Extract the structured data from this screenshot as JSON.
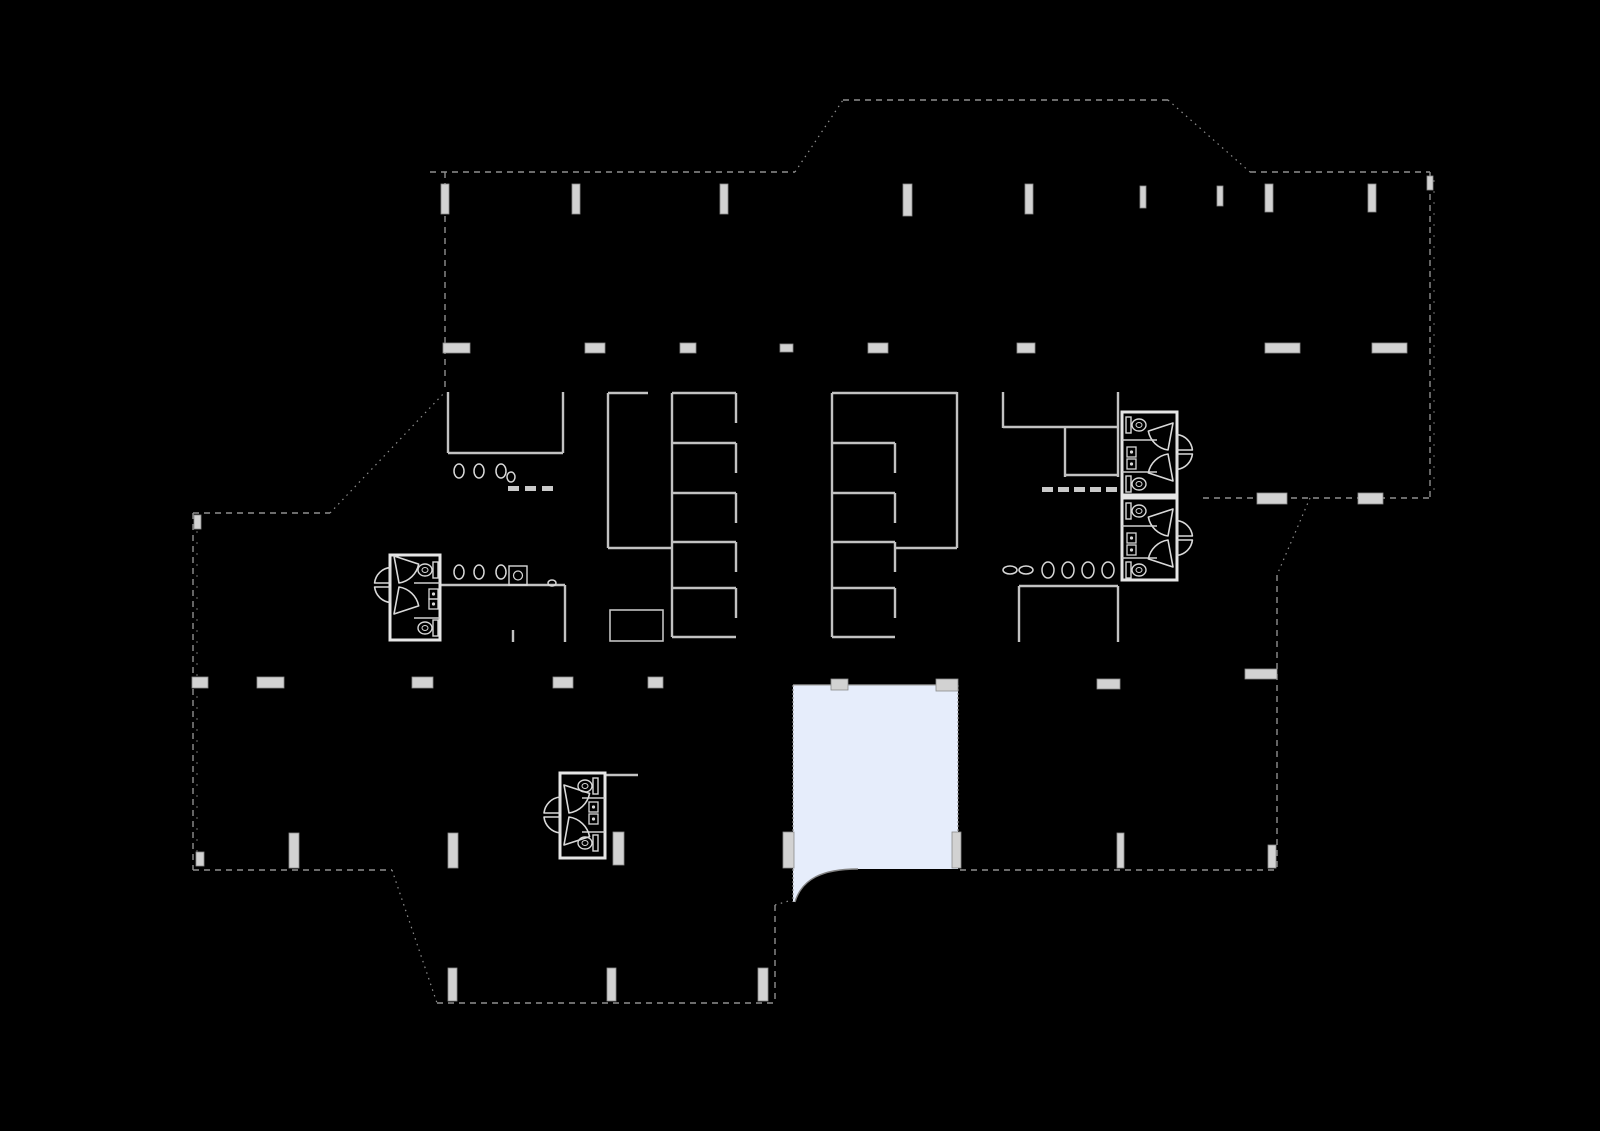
{
  "canvas": {
    "width": 1600,
    "height": 1131,
    "background": "#000000"
  },
  "palette": {
    "exterior_wall": "#8f8f8f",
    "exterior_tick": "#6f6f6f",
    "interior_wall": "#c2c2c2",
    "thin_wall": "#a8a8a8",
    "bright_wall": "#e6e6e6",
    "partition": "#cfcfcf",
    "column_fill": "#d2d2d2",
    "column_stroke": "#8a8a8a",
    "fixture": "#d8d8d8",
    "door": "#d9d9d9",
    "highlight_fill": "#e6edfb",
    "highlight_edge": "#909090",
    "highlight_arc": "#828282"
  },
  "floorplan": {
    "exterior_walls_dashed": [
      [
        430,
        172,
        795,
        172
      ],
      [
        843,
        100,
        1168,
        100
      ],
      [
        1250,
        172,
        1430,
        172
      ],
      [
        1430,
        172,
        1430,
        498
      ],
      [
        1203,
        498,
        1430,
        498
      ],
      [
        1277,
        575,
        1277,
        870
      ],
      [
        960,
        870,
        1277,
        870
      ],
      [
        437,
        1003,
        775,
        1003
      ],
      [
        193,
        870,
        392,
        870
      ],
      [
        193,
        513,
        193,
        870
      ],
      [
        193,
        513,
        330,
        513
      ],
      [
        445,
        172,
        445,
        392
      ],
      [
        775,
        905,
        775,
        1003
      ]
    ],
    "exterior_walls_dotted": [
      [
        795,
        172,
        843,
        100
      ],
      [
        1168,
        100,
        1250,
        172
      ],
      [
        1310,
        498,
        1277,
        575
      ],
      [
        330,
        513,
        445,
        392
      ],
      [
        392,
        870,
        437,
        1003
      ],
      [
        775,
        905,
        792,
        900
      ]
    ],
    "window_tick_lines": [
      [
        1434,
        180,
        1434,
        494
      ],
      [
        197,
        520,
        197,
        864
      ]
    ],
    "interior_walls": [
      [
        448,
        392,
        448,
        453
      ],
      [
        563,
        392,
        563,
        453
      ],
      [
        448,
        453,
        563,
        453
      ],
      [
        608,
        393,
        608,
        548
      ],
      [
        608,
        393,
        648,
        393
      ],
      [
        608,
        548,
        672,
        548
      ],
      [
        672,
        393,
        672,
        637
      ],
      [
        672,
        393,
        736,
        393
      ],
      [
        672,
        443,
        736,
        443
      ],
      [
        672,
        493,
        736,
        493
      ],
      [
        672,
        542,
        736,
        542
      ],
      [
        672,
        588,
        736,
        588
      ],
      [
        672,
        637,
        736,
        637
      ],
      [
        736,
        393,
        736,
        423
      ],
      [
        736,
        443,
        736,
        473
      ],
      [
        736,
        493,
        736,
        523
      ],
      [
        736,
        542,
        736,
        572
      ],
      [
        736,
        588,
        736,
        618
      ],
      [
        832,
        393,
        832,
        637
      ],
      [
        832,
        393,
        957,
        393
      ],
      [
        832,
        443,
        895,
        443
      ],
      [
        832,
        493,
        895,
        493
      ],
      [
        832,
        542,
        895,
        542
      ],
      [
        832,
        588,
        895,
        588
      ],
      [
        832,
        637,
        895,
        637
      ],
      [
        895,
        443,
        895,
        473
      ],
      [
        895,
        493,
        895,
        523
      ],
      [
        895,
        542,
        895,
        572
      ],
      [
        895,
        588,
        895,
        618
      ],
      [
        957,
        392,
        957,
        548
      ],
      [
        895,
        548,
        957,
        548
      ],
      [
        1003,
        392,
        1003,
        428
      ],
      [
        1003,
        427,
        1118,
        427
      ],
      [
        1065,
        427,
        1065,
        477
      ],
      [
        1065,
        475,
        1118,
        475
      ],
      [
        1118,
        392,
        1118,
        477
      ],
      [
        1019,
        586,
        1118,
        586
      ],
      [
        1019,
        586,
        1019,
        642
      ],
      [
        1118,
        586,
        1118,
        642
      ],
      [
        440,
        585,
        565,
        585
      ],
      [
        565,
        585,
        565,
        642
      ],
      [
        513,
        630,
        513,
        642
      ],
      [
        605,
        775,
        638,
        775
      ]
    ],
    "thin_walls": [
      [
        793,
        685,
        958,
        685
      ]
    ],
    "outline_rects": [
      {
        "x": 610,
        "y": 610,
        "w": 53,
        "h": 31
      }
    ],
    "bathroom_blocks": [
      {
        "x": 390,
        "y": 555,
        "w": 50,
        "h": 85
      },
      {
        "x": 560,
        "y": 773,
        "w": 45,
        "h": 85
      },
      {
        "x": 1122,
        "y": 412,
        "w": 55,
        "h": 83
      },
      {
        "x": 1122,
        "y": 498,
        "w": 55,
        "h": 82
      }
    ],
    "stall_partitions": [
      [
        414,
        583,
        440,
        583
      ],
      [
        414,
        618,
        440,
        618
      ],
      [
        582,
        798,
        605,
        798
      ],
      [
        582,
        832,
        605,
        832
      ],
      [
        1122,
        440,
        1157,
        440
      ],
      [
        1122,
        472,
        1157,
        472
      ],
      [
        1122,
        526,
        1157,
        526
      ],
      [
        1122,
        558,
        1157,
        558
      ]
    ],
    "columns": [
      {
        "x": 441,
        "y": 184,
        "w": 8,
        "h": 30
      },
      {
        "x": 572,
        "y": 184,
        "w": 8,
        "h": 30
      },
      {
        "x": 720,
        "y": 184,
        "w": 8,
        "h": 30
      },
      {
        "x": 903,
        "y": 184,
        "w": 9,
        "h": 32
      },
      {
        "x": 1025,
        "y": 184,
        "w": 8,
        "h": 30
      },
      {
        "x": 1140,
        "y": 186,
        "w": 6,
        "h": 22
      },
      {
        "x": 1217,
        "y": 186,
        "w": 6,
        "h": 20
      },
      {
        "x": 1265,
        "y": 184,
        "w": 8,
        "h": 28
      },
      {
        "x": 1368,
        "y": 184,
        "w": 8,
        "h": 28
      },
      {
        "x": 194,
        "y": 515,
        "w": 7,
        "h": 14
      },
      {
        "x": 1427,
        "y": 176,
        "w": 6,
        "h": 14
      },
      {
        "x": 443,
        "y": 343,
        "w": 27,
        "h": 10
      },
      {
        "x": 585,
        "y": 343,
        "w": 20,
        "h": 10
      },
      {
        "x": 680,
        "y": 343,
        "w": 16,
        "h": 10
      },
      {
        "x": 780,
        "y": 344,
        "w": 13,
        "h": 8
      },
      {
        "x": 868,
        "y": 343,
        "w": 20,
        "h": 10
      },
      {
        "x": 1017,
        "y": 343,
        "w": 18,
        "h": 10
      },
      {
        "x": 1265,
        "y": 343,
        "w": 35,
        "h": 10
      },
      {
        "x": 1372,
        "y": 343,
        "w": 35,
        "h": 10
      },
      {
        "x": 1257,
        "y": 493,
        "w": 30,
        "h": 11
      },
      {
        "x": 1358,
        "y": 493,
        "w": 25,
        "h": 11
      },
      {
        "x": 192,
        "y": 677,
        "w": 16,
        "h": 11
      },
      {
        "x": 257,
        "y": 677,
        "w": 27,
        "h": 11
      },
      {
        "x": 412,
        "y": 677,
        "w": 21,
        "h": 11
      },
      {
        "x": 553,
        "y": 677,
        "w": 20,
        "h": 11
      },
      {
        "x": 648,
        "y": 677,
        "w": 15,
        "h": 11
      },
      {
        "x": 831,
        "y": 679,
        "w": 17,
        "h": 11
      },
      {
        "x": 936,
        "y": 679,
        "w": 22,
        "h": 12
      },
      {
        "x": 1097,
        "y": 679,
        "w": 23,
        "h": 10
      },
      {
        "x": 1245,
        "y": 669,
        "w": 32,
        "h": 10
      },
      {
        "x": 289,
        "y": 833,
        "w": 10,
        "h": 35
      },
      {
        "x": 448,
        "y": 833,
        "w": 10,
        "h": 35
      },
      {
        "x": 613,
        "y": 832,
        "w": 11,
        "h": 33
      },
      {
        "x": 783,
        "y": 832,
        "w": 11,
        "h": 36
      },
      {
        "x": 952,
        "y": 832,
        "w": 9,
        "h": 36
      },
      {
        "x": 1117,
        "y": 833,
        "w": 7,
        "h": 35
      },
      {
        "x": 196,
        "y": 852,
        "w": 8,
        "h": 14
      },
      {
        "x": 1268,
        "y": 845,
        "w": 8,
        "h": 23
      },
      {
        "x": 448,
        "y": 968,
        "w": 9,
        "h": 33
      },
      {
        "x": 607,
        "y": 968,
        "w": 9,
        "h": 33
      },
      {
        "x": 758,
        "y": 968,
        "w": 10,
        "h": 33
      }
    ],
    "toilets": [
      {
        "x": 1126,
        "cy": 425,
        "dir": 1
      },
      {
        "x": 1126,
        "cy": 484,
        "dir": 1
      },
      {
        "x": 1126,
        "cy": 511,
        "dir": 1
      },
      {
        "x": 1126,
        "cy": 570,
        "dir": 1
      },
      {
        "x": 438,
        "cy": 570,
        "dir": -1
      },
      {
        "x": 438,
        "cy": 628,
        "dir": -1
      },
      {
        "x": 598,
        "cy": 786,
        "dir": -1
      },
      {
        "x": 598,
        "cy": 843,
        "dir": -1
      }
    ],
    "sinks": [
      {
        "x": 1127,
        "y": 447
      },
      {
        "x": 1127,
        "y": 459
      },
      {
        "x": 1127,
        "y": 533
      },
      {
        "x": 1127,
        "y": 545
      },
      {
        "x": 429,
        "y": 589
      },
      {
        "x": 429,
        "y": 599
      },
      {
        "x": 589,
        "y": 802
      },
      {
        "x": 589,
        "y": 814
      }
    ],
    "counter_sink": {
      "x": 509,
      "y": 566,
      "w": 18,
      "h": 19
    },
    "urinals": [
      {
        "cx": 459,
        "cy": 471,
        "rx": 5,
        "ry": 7
      },
      {
        "cx": 479,
        "cy": 471,
        "rx": 5,
        "ry": 7
      },
      {
        "cx": 501,
        "cy": 471,
        "rx": 5,
        "ry": 7
      },
      {
        "cx": 511,
        "cy": 477,
        "rx": 4,
        "ry": 5
      },
      {
        "cx": 459,
        "cy": 572,
        "rx": 5,
        "ry": 7
      },
      {
        "cx": 479,
        "cy": 572,
        "rx": 5,
        "ry": 7
      },
      {
        "cx": 501,
        "cy": 572,
        "rx": 5,
        "ry": 7
      },
      {
        "cx": 552,
        "cy": 583,
        "rx": 4,
        "ry": 3
      },
      {
        "cx": 1048,
        "cy": 570,
        "rx": 6,
        "ry": 8
      },
      {
        "cx": 1068,
        "cy": 570,
        "rx": 6,
        "ry": 8
      },
      {
        "cx": 1088,
        "cy": 570,
        "rx": 6,
        "ry": 8
      },
      {
        "cx": 1108,
        "cy": 570,
        "rx": 6,
        "ry": 8
      },
      {
        "cx": 1010,
        "cy": 570,
        "rx": 7,
        "ry": 4
      },
      {
        "cx": 1026,
        "cy": 570,
        "rx": 7,
        "ry": 4
      }
    ],
    "dash_marks": [
      {
        "x": 508,
        "y": 486
      },
      {
        "x": 525,
        "y": 486
      },
      {
        "x": 542,
        "y": 486
      },
      {
        "x": 1042,
        "y": 487
      },
      {
        "x": 1058,
        "y": 487
      },
      {
        "x": 1074,
        "y": 487
      },
      {
        "x": 1090,
        "y": 487
      },
      {
        "x": 1106,
        "y": 487
      }
    ],
    "swing_doors": [
      {
        "w": 392,
        "cy": 585,
        "r": 29,
        "dir": 1
      },
      {
        "w": 562,
        "cy": 815,
        "r": 30,
        "dir": 1
      },
      {
        "w": 1175,
        "cy": 452,
        "r": 29,
        "dir": -1
      },
      {
        "w": 1175,
        "cy": 538,
        "r": 29,
        "dir": -1
      }
    ],
    "highlighted_room": {
      "path": "M793,685 L958,685 L958,869 L858,869 C822,869 802,879 795,902 L793,902 Z",
      "arc": "M858,869 C822,869 802,879 795,902",
      "edges": [
        [
          793,
          685,
          793,
          902
        ],
        [
          958,
          685,
          958,
          869
        ]
      ]
    }
  }
}
